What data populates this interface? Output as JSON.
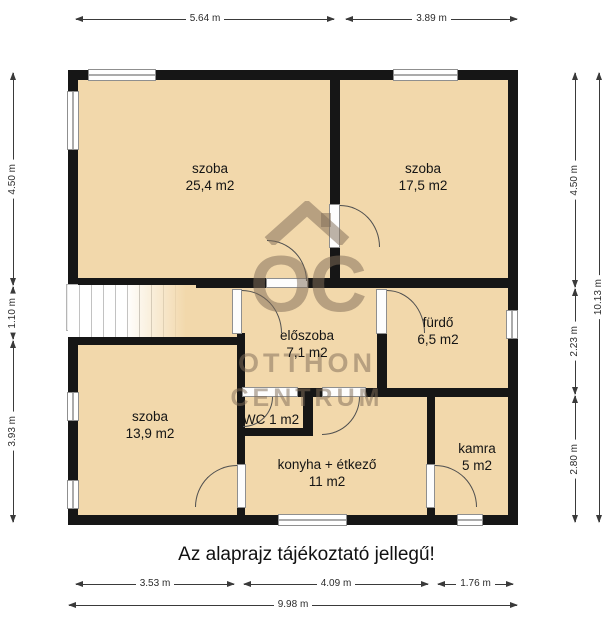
{
  "title": "Az alaprajz tájékoztató jellegű!",
  "watermark": {
    "logo_text": "OC",
    "line1": "OTTHON",
    "line2": "CENTRUM"
  },
  "colors": {
    "room_fill": "#f2d8ab",
    "wall": "#161616",
    "watermark": "rgba(128,110,88,0.52)"
  },
  "rooms": [
    {
      "name": "szoba",
      "area": "25,4 m2"
    },
    {
      "name": "szoba",
      "area": "17,5 m2"
    },
    {
      "name": "előszoba",
      "area": "7,1 m2"
    },
    {
      "name": "fürdő",
      "area": "6,5 m2"
    },
    {
      "name": "szoba",
      "area": "13,9 m2"
    },
    {
      "name": "WC",
      "area": "1 m2"
    },
    {
      "name": "konyha + étkező",
      "area": "11 m2"
    },
    {
      "name": "kamra",
      "area": "5 m2"
    }
  ],
  "dimensions": {
    "top": [
      "5.64 m",
      "3.89 m"
    ],
    "left": [
      "4.50 m",
      "1.10 m",
      "3.93 m"
    ],
    "right": [
      "4.50 m",
      "2.23 m",
      "2.80 m"
    ],
    "right_total": "10.13 m",
    "bottom": [
      "3.53 m",
      "4.09 m",
      "1.76 m"
    ],
    "bottom_total": "9.98 m"
  }
}
